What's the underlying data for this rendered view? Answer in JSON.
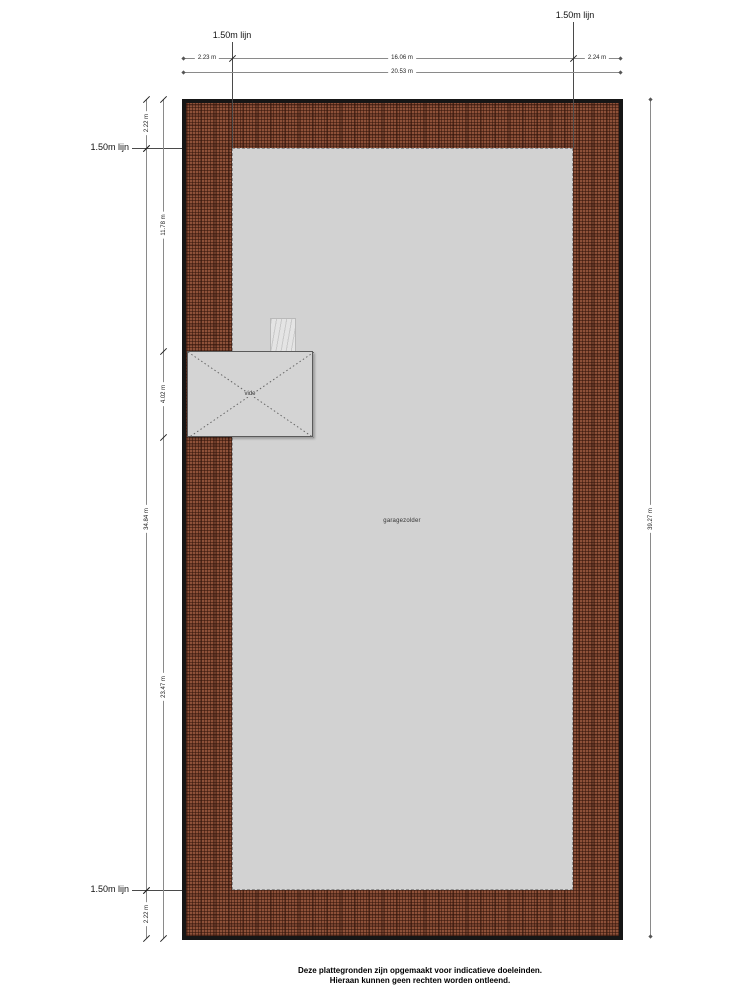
{
  "plan": {
    "room_label": "garagezolder",
    "vide_label": "vide",
    "height_line_label": "1.50m lijn"
  },
  "dimensions": {
    "top_left": "2.23 m",
    "top_middle": "16.06 m",
    "top_right": "2.24 m",
    "top_total": "20.53 m",
    "left_outer_top": "2.22 m",
    "left_outer_middle": "34.84 m",
    "left_outer_bottom": "2.22 m",
    "left_inner_top": "11.78 m",
    "left_inner_vide": "4.02 m",
    "left_inner_bottom": "23.47 m",
    "right_total": "39.27 m"
  },
  "disclaimer": {
    "line1": "Deze plattegronden zijn opgemaakt voor indicatieve doeleinden.",
    "line2": "Hieraan kunnen geen rechten worden ontleend."
  },
  "colors": {
    "roof_hatch": "#8e5139",
    "floor": "#d2d2d2",
    "outline": "#161616",
    "dimension_line": "#8a8a8a"
  }
}
